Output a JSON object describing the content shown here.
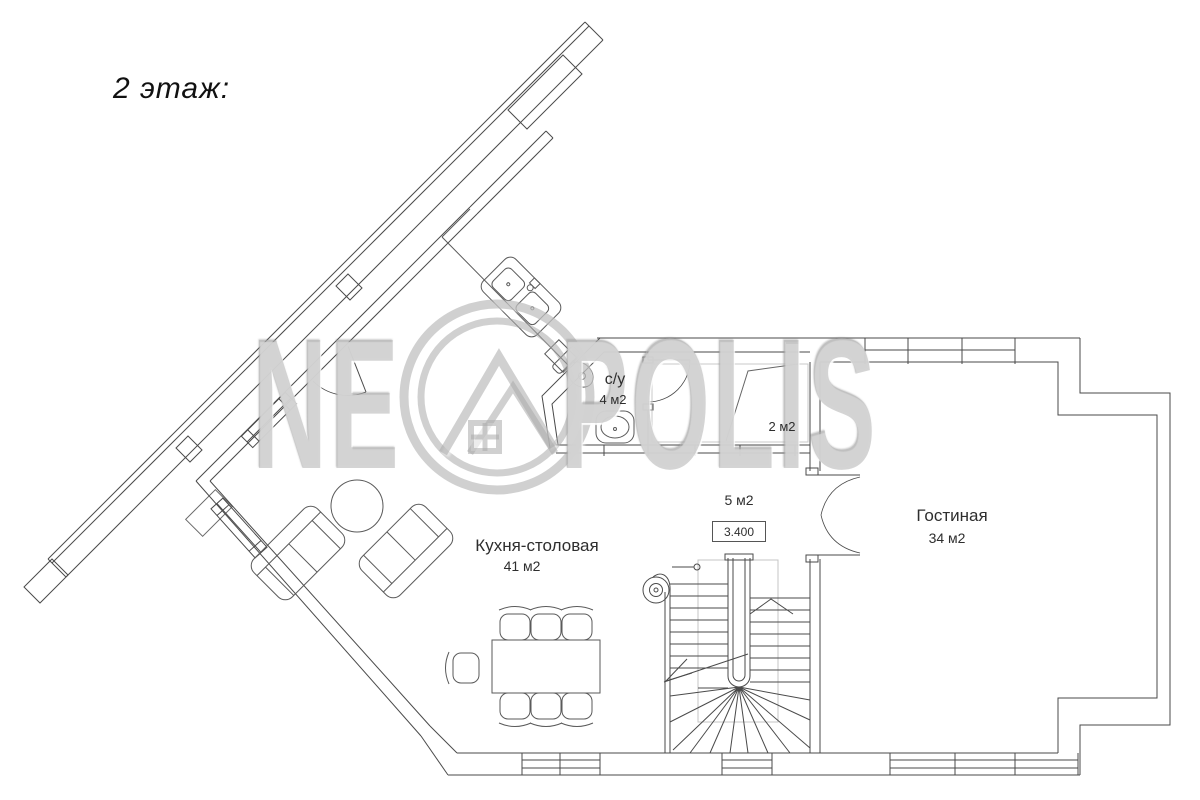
{
  "title": "2 этаж:",
  "watermark": {
    "left_text": "NE",
    "right_text": "POLIS",
    "logo": "neopolis-roof-logo",
    "color": "#b2b2b2"
  },
  "plan": {
    "line_color": "#4a4a4a",
    "rooms": {
      "kitchen": {
        "name": "Кухня-столовая",
        "area": "41 м2"
      },
      "living": {
        "name": "Гостиная",
        "area": "34 м2"
      },
      "bathroom": {
        "name": "с/у",
        "area": "4 м2"
      },
      "closet": {
        "area": "2 м2"
      },
      "hall": {
        "area": "5 м2",
        "elevation": "3.400"
      }
    }
  }
}
